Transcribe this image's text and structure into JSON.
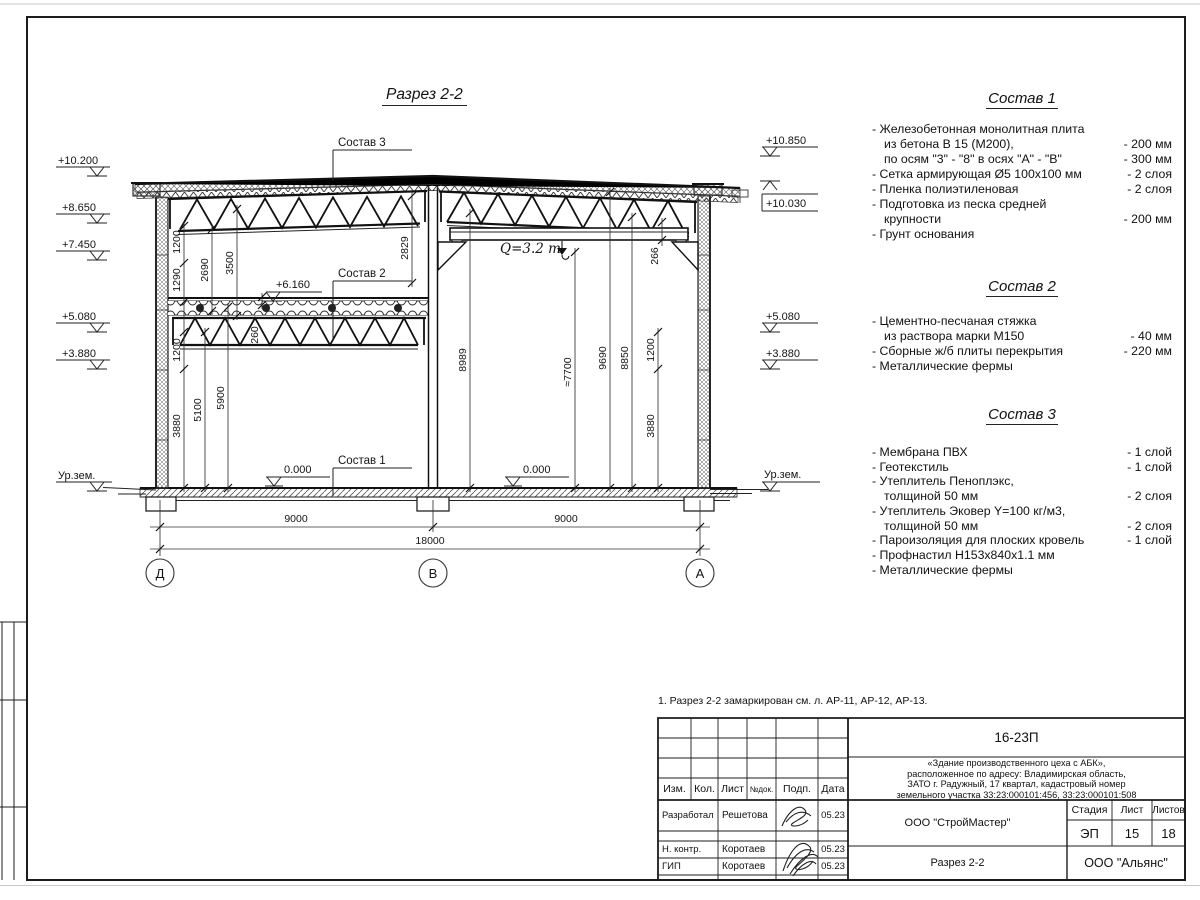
{
  "sheet": {
    "drawing_title": "Разрез 2-2",
    "note": "1. Разрез 2-2 замаркирован см. л. АР-11, АР-12, АР-13."
  },
  "section": {
    "labels": {
      "s1": "Состав 1",
      "s2": "Состав 2",
      "s3": "Состав 3",
      "crane": "Q=3.2 т",
      "p6160": "+6.160",
      "zl": "0.000",
      "zr": "0.000"
    },
    "elev": {
      "l1": "+10.200",
      "l2": "+8.650",
      "l3": "+7.450",
      "l4": "+5.080",
      "l5": "+3.880",
      "lg": "Ур.зем.",
      "r1": "+10.850",
      "r2": "+10.030",
      "r3": "+5.080",
      "r4": "+3.880",
      "rg": "Ур.зем."
    },
    "dims": {
      "v1200a": "1200",
      "v1290": "1290",
      "v1200b": "1200",
      "v3880l": "3880",
      "v5100": "5100",
      "v5900": "5900",
      "v2690": "2690",
      "v3500": "3500",
      "v260": "260",
      "v2829": "2829",
      "v8989": "8989",
      "v7700": "≈7700",
      "v9690": "9690",
      "v8850": "8850",
      "v1200r": "1200",
      "v3880r": "3880",
      "v266": "266",
      "b9000a": "9000",
      "b9000b": "9000",
      "b18000": "18000"
    },
    "axes": {
      "a1": "Д",
      "a2": "В",
      "a3": "А"
    }
  },
  "spec1": {
    "title": "Состав 1",
    "items": [
      {
        "t": "- Железобетонная  монолитная плита",
        "v": ""
      },
      {
        "t": "из бетона В 15 (М200),",
        "v": "- 200 мм"
      },
      {
        "t": "по осям \"3\" - \"8\" в осях \"А\" - \"В\"",
        "v": "- 300 мм"
      },
      {
        "t": "- Сетка армирующая Ø5 100х100 мм",
        "v": "- 2 слоя"
      },
      {
        "t": "- Пленка полиэтиленовая",
        "v": "-  2 слоя"
      },
      {
        "t": "- Подготовка из песка средней",
        "v": ""
      },
      {
        "t": "крупности",
        "v": "- 200 мм"
      },
      {
        "t": "- Грунт основания",
        "v": ""
      }
    ]
  },
  "spec2": {
    "title": "Состав 2",
    "items": [
      {
        "t": "- Цементно-песчаная стяжка",
        "v": ""
      },
      {
        "t": "из раствора марки М150",
        "v": "- 40 мм"
      },
      {
        "t": "- Сборные ж/б плиты перекрытия",
        "v": "- 220 мм"
      },
      {
        "t": "- Металлические фермы",
        "v": ""
      }
    ]
  },
  "spec3": {
    "title": "Состав 3",
    "items": [
      {
        "t": "- Мембрана ПВХ",
        "v": "- 1 слой"
      },
      {
        "t": "- Геотекстиль",
        "v": "- 1 слой"
      },
      {
        "t": "- Утеплитель Пеноплэкс,",
        "v": ""
      },
      {
        "t": "толщиной 50 мм",
        "v": "- 2 слоя"
      },
      {
        "t": "- Утеплитель Эковер Y=100 кг/м3,",
        "v": ""
      },
      {
        "t": "толщиной 50 мм",
        "v": "- 2 слоя"
      },
      {
        "t": "- Пароизоляция для плоских кровель",
        "v": "- 1 слой"
      },
      {
        "t": "- Профнастил Н153х840х1.1 мм",
        "v": ""
      },
      {
        "t": "- Металлические фермы",
        "v": ""
      }
    ]
  },
  "titleblock": {
    "doc_number": "16-23П",
    "object_lines": [
      "«Здание производственного цеха с АБК»,",
      "расположенное по адресу: Владимирская область,",
      "ЗАТО г. Радужный, 17 квартал, кадастровый номер",
      "земельного участка 33:23:000101:456, 33:23:000101:508"
    ],
    "cols": {
      "izm": "Изм.",
      "kol": "Кол.",
      "list": "Лист",
      "ndok": "№док.",
      "podp": "Подп.",
      "data": "Дата"
    },
    "rows": {
      "r1_role": "Разработал",
      "r1_name": "Решетова",
      "r1_date": "05.23",
      "r2_role": "Н. контр.",
      "r2_name": "Коротаев",
      "r2_date": "05.23",
      "r3_role": "ГИП",
      "r3_name": "Коротаев",
      "r3_date": "05.23"
    },
    "org": "ООО \"СтройМастер\"",
    "sheet_title": "Разрез 2-2",
    "customer": "ООО \"Альянс\"",
    "stage_label": "Стадия",
    "list_label": "Лист",
    "listov_label": "Листов",
    "stage": "ЭП",
    "list_no": "15",
    "listov": "18"
  }
}
